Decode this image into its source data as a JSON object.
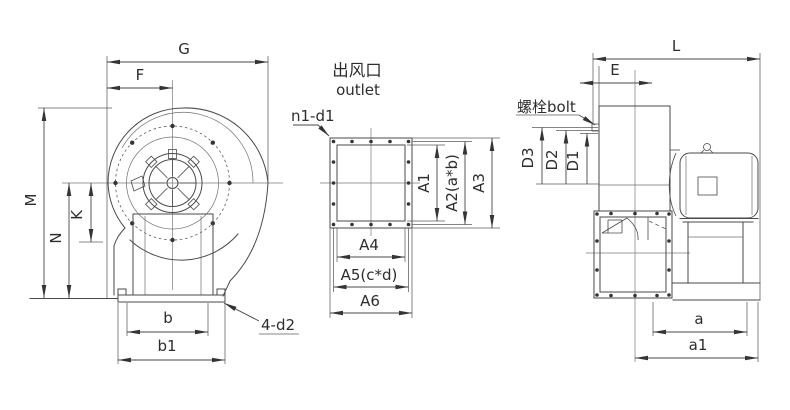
{
  "drawing": {
    "left_view": {
      "dim_G": "G",
      "dim_F": "F",
      "dim_M": "M",
      "dim_N": "N",
      "dim_K": "K",
      "dim_b": "b",
      "dim_b1": "b1",
      "leader_holes": "4-d2"
    },
    "outlet_view": {
      "title_cn": "出风口",
      "title_en": "outlet",
      "leader_holes": "n1-d1",
      "dim_A1": "A1",
      "dim_A2": "A2(a*b)",
      "dim_A3": "A3",
      "dim_A4": "A4",
      "dim_A5": "A5(c*d)",
      "dim_A6": "A6"
    },
    "right_view": {
      "leader_bolt": "螺栓bolt",
      "dim_L": "L",
      "dim_E": "E",
      "dim_D3": "D3",
      "dim_D2": "D2",
      "dim_D1": "D1",
      "dim_a": "a",
      "dim_a1": "a1"
    },
    "colors": {
      "line": "#4a4a4a",
      "text": "#2d2d2d",
      "background": "#ffffff"
    }
  }
}
